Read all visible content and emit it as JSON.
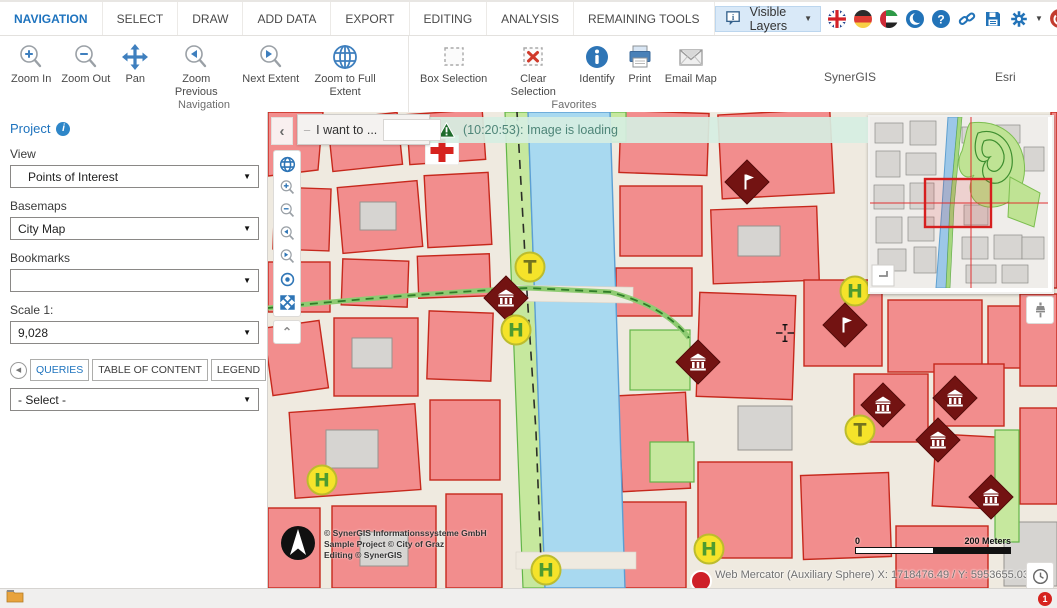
{
  "menu": {
    "tabs": [
      {
        "label": "NAVIGATION",
        "active": true
      },
      {
        "label": "SELECT"
      },
      {
        "label": "DRAW"
      },
      {
        "label": "ADD DATA"
      },
      {
        "label": "EXPORT"
      },
      {
        "label": "EDITING"
      },
      {
        "label": "ANALYSIS"
      },
      {
        "label": "REMAINING TOOLS"
      }
    ],
    "visible_layers_label": "Visible Layers",
    "topbar_icons": [
      "speech-bubble-info",
      "flag-uk",
      "flag-germany",
      "flag-uae",
      "moon",
      "help",
      "link",
      "save",
      "settings-gear",
      "power",
      "collapse-chevron"
    ]
  },
  "ribbon": {
    "groups": [
      {
        "label": "Navigation",
        "tools": [
          {
            "label": "Zoom In",
            "icon": "magnifier-plus"
          },
          {
            "label": "Zoom Out",
            "icon": "magnifier-minus"
          },
          {
            "label": "Pan",
            "icon": "pan-arrows"
          },
          {
            "label": "Zoom Previous",
            "icon": "magnifier-back"
          },
          {
            "label": "Next Extent",
            "icon": "magnifier-forward"
          },
          {
            "label": "Zoom to Full Extent",
            "icon": "globe"
          }
        ]
      },
      {
        "label": "Favorites",
        "tools": [
          {
            "label": "Box Selection",
            "icon": "dashed-box"
          },
          {
            "label": "Clear Selection",
            "icon": "dashed-box-x"
          },
          {
            "label": "Identify",
            "icon": "info-circle"
          },
          {
            "label": "Print",
            "icon": "printer"
          },
          {
            "label": "Email Map",
            "icon": "envelope"
          }
        ]
      }
    ],
    "brand_left": "SynerGIS",
    "brand_right": "Esri"
  },
  "sidebar": {
    "project_label": "Project",
    "fields": [
      {
        "label": "View",
        "value": "Points of Interest"
      },
      {
        "label": "Basemaps",
        "value": "City Map"
      },
      {
        "label": "Bookmarks",
        "value": ""
      },
      {
        "label": "Scale 1:",
        "value": "9,028"
      }
    ],
    "tabs": [
      {
        "label": "QUERIES",
        "active": true
      },
      {
        "label": "TABLE OF CONTENT"
      },
      {
        "label": "LEGEND"
      }
    ],
    "query_select_value": "- Select -"
  },
  "map": {
    "want_label": "I want to ...",
    "want_input_value": "",
    "notification": "(10:20:53): Image is loading",
    "copyright_lines": [
      "© SynerGIS Informationssysteme GmbH",
      "Sample Project © City of Graz",
      "Editing © SynerGIS"
    ],
    "scale_left": "0",
    "scale_right": "200 Meters",
    "status_coordinates": "Web Mercator (Auxiliary Sphere) X: 1718476.49 / Y: 5953655.03",
    "markers": [
      {
        "type": "pharmacy",
        "x": 174,
        "y": 38
      },
      {
        "type": "tram",
        "label": "T",
        "x": 262,
        "y": 155
      },
      {
        "type": "museum",
        "x": 238,
        "y": 186
      },
      {
        "type": "hospital",
        "label": "H",
        "x": 248,
        "y": 218
      },
      {
        "type": "hospital",
        "label": "H",
        "x": 54,
        "y": 368
      },
      {
        "type": "hospital",
        "label": "H",
        "x": 278,
        "y": 458
      },
      {
        "type": "hospital",
        "label": "H",
        "x": 441,
        "y": 437
      },
      {
        "type": "hospital",
        "label": "H",
        "x": 587,
        "y": 179
      },
      {
        "type": "flag",
        "x": 479,
        "y": 70
      },
      {
        "type": "flag",
        "x": 577,
        "y": 213
      },
      {
        "type": "museum",
        "x": 430,
        "y": 250
      },
      {
        "type": "museum",
        "x": 615,
        "y": 293
      },
      {
        "type": "museum",
        "x": 687,
        "y": 286
      },
      {
        "type": "museum",
        "x": 670,
        "y": 328
      },
      {
        "type": "museum",
        "x": 723,
        "y": 385
      },
      {
        "type": "tram",
        "label": "T",
        "x": 592,
        "y": 318
      }
    ]
  },
  "statusbar": {
    "badge": "1"
  },
  "colors": {
    "accent_blue": "#1E73BE",
    "marker_yellow": "#F5E32A",
    "marker_maroon": "#731312",
    "notification_bg": "#D7EEE3",
    "building_fill": "#F28D8D",
    "building_stroke": "#C6281C",
    "river": "#A8D9F0"
  }
}
